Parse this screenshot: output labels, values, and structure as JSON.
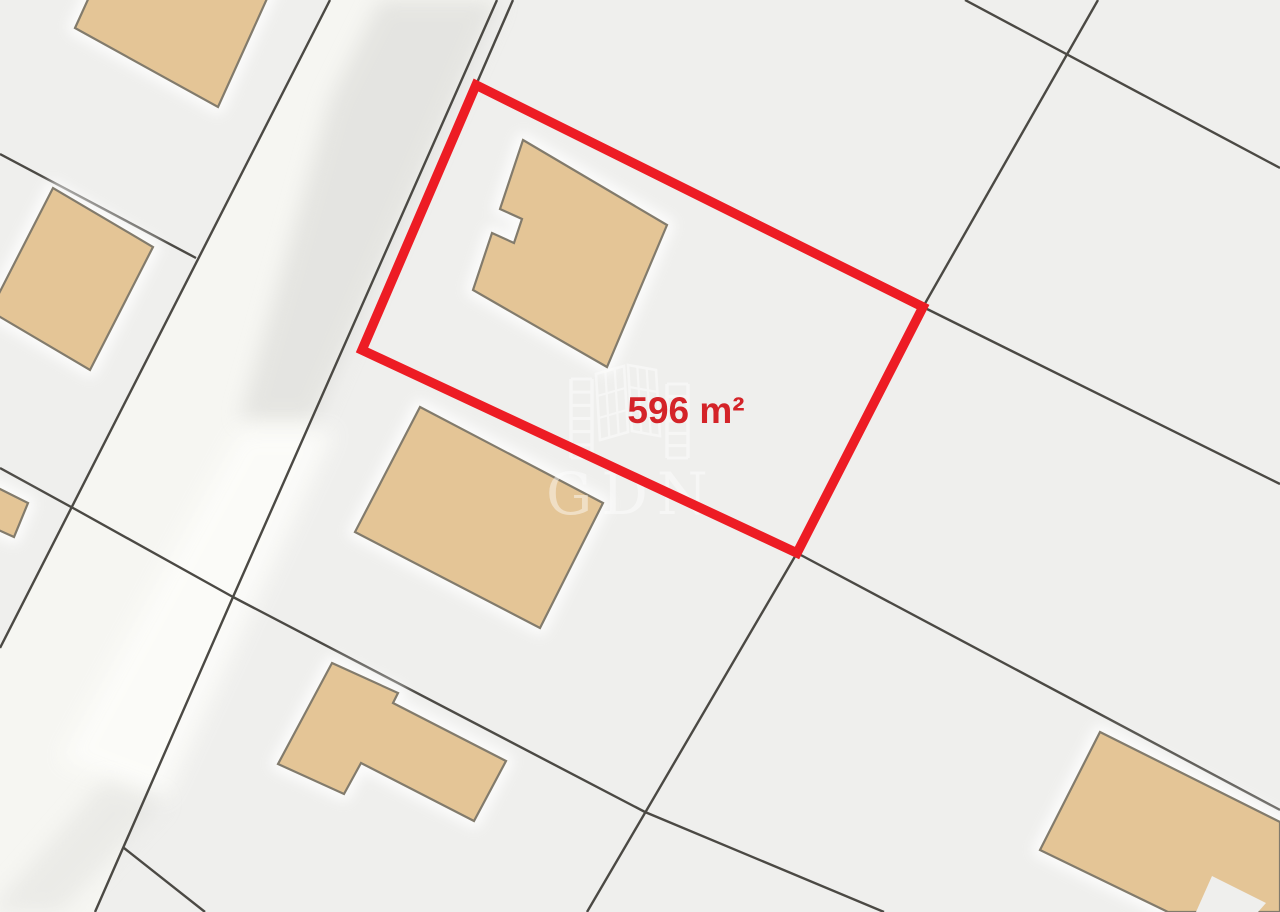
{
  "map": {
    "background": "#efefed",
    "colors": {
      "road_fill": "#f6f6f2",
      "boundary_line": "#4b4944",
      "building_fill": "#e4c596",
      "building_stroke": "#827b6c",
      "building_halo": "#ffffff",
      "highlight_stroke": "#ed1c24",
      "label_color": "#d42328",
      "watermark_color": "#ffffff"
    },
    "road": {
      "surface": [
        [
          330,
          0
        ],
        [
          497,
          0
        ],
        [
          233,
          597
        ],
        [
          95,
          912
        ],
        [
          -80,
          912
        ],
        [
          0,
          648
        ]
      ],
      "edges": [
        [
          [
            330,
            0
          ],
          [
            0,
            648
          ]
        ],
        [
          [
            497,
            0
          ],
          [
            233,
            597
          ],
          [
            95,
            912
          ]
        ]
      ],
      "shading": [
        {
          "points": [
            [
              380,
              0
            ],
            [
              500,
              0
            ],
            [
              315,
              420
            ],
            [
              240,
              420
            ],
            [
              330,
              100
            ]
          ],
          "fill": "#d9d9d6",
          "opacity": 0.6,
          "blur": "blur10"
        },
        {
          "points": [
            [
              240,
              430
            ],
            [
              335,
              430
            ],
            [
              165,
              800
            ],
            [
              60,
              760
            ]
          ],
          "fill": "#fdfdfa",
          "opacity": 0.85,
          "blur": "blur10"
        },
        {
          "points": [
            [
              105,
              780
            ],
            [
              165,
              800
            ],
            [
              60,
              912
            ],
            [
              -10,
              912
            ]
          ],
          "fill": "#e0e0dd",
          "opacity": 0.5,
          "blur": "blur10"
        }
      ]
    },
    "boundary_lines": [
      [
        [
          0,
          154
        ],
        [
          196,
          258
        ]
      ],
      [
        [
          0,
          468
        ],
        [
          73,
          508
        ],
        [
          233,
          597
        ]
      ],
      [
        [
          233,
          597
        ],
        [
          645,
          812
        ],
        [
          884,
          912
        ]
      ],
      [
        [
          124,
          848
        ],
        [
          205,
          912
        ]
      ],
      [
        [
          513,
          0
        ],
        [
          476,
          85
        ]
      ],
      [
        [
          1098,
          0
        ],
        [
          923,
          307
        ]
      ],
      [
        [
          965,
          0
        ],
        [
          1280,
          168
        ]
      ],
      [
        [
          923,
          307
        ],
        [
          1280,
          484
        ]
      ],
      [
        [
          797,
          553
        ],
        [
          1280,
          810
        ]
      ],
      [
        [
          797,
          553
        ],
        [
          587,
          912
        ]
      ]
    ],
    "buildings": [
      {
        "name": "building-top-left",
        "points": [
          [
            75,
            28
          ],
          [
            141,
            -117
          ],
          [
            284,
            -39
          ],
          [
            218,
            107
          ]
        ]
      },
      {
        "name": "building-left-middle",
        "points": [
          [
            -10,
            311
          ],
          [
            53,
            188
          ],
          [
            153,
            247
          ],
          [
            90,
            370
          ]
        ]
      },
      {
        "name": "building-left-small",
        "points": [
          [
            -6,
            486
          ],
          [
            28,
            503
          ],
          [
            14,
            537
          ],
          [
            -6,
            528
          ]
        ]
      },
      {
        "name": "building-main-house",
        "points": [
          [
            523,
            140
          ],
          [
            667,
            225
          ],
          [
            607,
            367
          ],
          [
            473,
            290
          ],
          [
            492,
            233
          ],
          [
            514,
            243
          ],
          [
            522,
            219
          ],
          [
            500,
            209
          ]
        ]
      },
      {
        "name": "building-lower-house",
        "points": [
          [
            420,
            407
          ],
          [
            603,
            503
          ],
          [
            540,
            628
          ],
          [
            355,
            532
          ]
        ]
      },
      {
        "name": "building-l-shaped",
        "points": [
          [
            332,
            663
          ],
          [
            398,
            693
          ],
          [
            393,
            703
          ],
          [
            506,
            761
          ],
          [
            474,
            821
          ],
          [
            361,
            763
          ],
          [
            344,
            794
          ],
          [
            278,
            764
          ]
        ]
      },
      {
        "name": "building-bottom-right",
        "points": [
          [
            1100,
            732
          ],
          [
            1280,
            822
          ],
          [
            1280,
            912
          ],
          [
            1168,
            912
          ],
          [
            1040,
            850
          ]
        ]
      }
    ],
    "building_cutouts": [
      {
        "points": [
          [
            1196,
            912
          ],
          [
            1212,
            876
          ],
          [
            1266,
            903
          ],
          [
            1258,
            912
          ]
        ]
      }
    ],
    "highlight": {
      "points": [
        [
          476,
          85
        ],
        [
          923,
          307
        ],
        [
          797,
          553
        ],
        [
          362,
          350
        ]
      ],
      "stroke_width": 9.5,
      "label": "596 m²",
      "label_x": 686,
      "label_y": 423,
      "label_size": 37
    },
    "watermark": {
      "text": "GDN",
      "text_x": 546,
      "text_y": 514,
      "text_size": 58,
      "opacity": 0.45,
      "ladders": [
        {
          "x": 571,
          "y": 379,
          "w": 21,
          "h": 79,
          "rungs": 6
        },
        {
          "x": 667,
          "y": 384,
          "w": 21,
          "h": 74,
          "rungs": 6
        }
      ],
      "panels": [
        {
          "points": [
            [
              596,
              374
            ],
            [
              624,
              366
            ],
            [
              628,
              432
            ],
            [
              600,
              440
            ]
          ]
        },
        {
          "points": [
            [
              628,
              365
            ],
            [
              656,
              370
            ],
            [
              660,
              436
            ],
            [
              632,
              431
            ]
          ]
        }
      ]
    }
  }
}
